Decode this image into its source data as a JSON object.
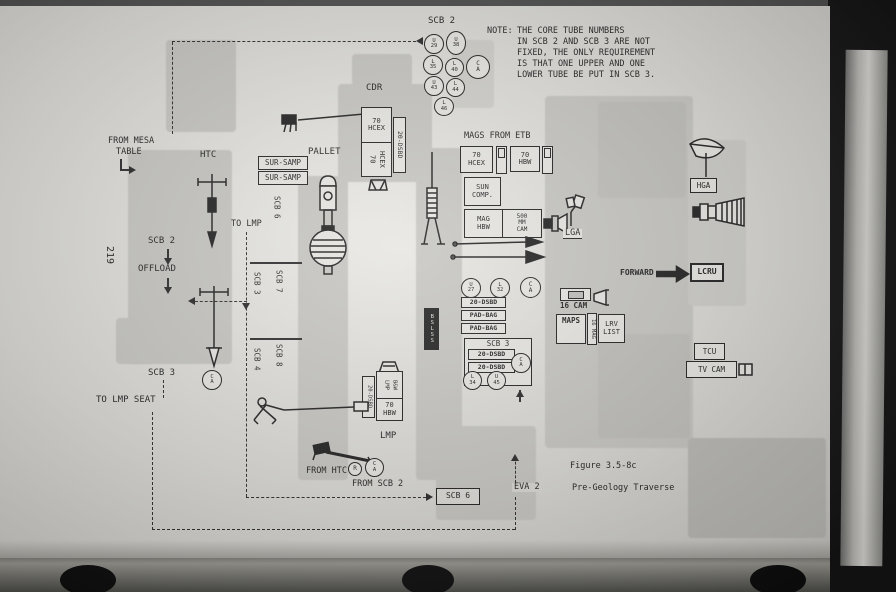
{
  "page_number": "219",
  "note": {
    "label": "NOTE:",
    "lines": [
      "THE CORE TUBE NUMBERS",
      "IN SCB 2 AND SCB 3 ARE NOT",
      "FIXED, THE ONLY REQUIREMENT",
      "IS THAT ONE UPPER AND ONE",
      "LOWER TUBE BE PUT IN SCB 3."
    ]
  },
  "caption": {
    "figure": "Figure 3.5-8c",
    "eva": "EVA 2",
    "title": "Pre-Geology Traverse"
  },
  "labels": {
    "scb2": "SCB 2",
    "scb3": "SCB 3",
    "scb4": "SCB 4",
    "scb6": "SCB 6",
    "scb7": "SCB 7",
    "scb8": "SCB 8",
    "cdr": "CDR",
    "lmp": "LMP",
    "htc": "HTC",
    "pallet": "PALLET",
    "from_mesa": "FROM MESA",
    "table": "TABLE",
    "sur_samp": "SUR-SAMP",
    "to_lmp": "TO LMP",
    "offload": "OFFLOAD",
    "to_lmp_seat": "TO LMP SEAT",
    "mags_from_etb": "MAGS FROM ETB",
    "seventy": "70",
    "hcex": "HCEX",
    "hbw": "HBW",
    "sun": "SUN",
    "comp": "COMP.",
    "mag": "MAG",
    "f500": "500",
    "mm": "MM",
    "cam": "CAM",
    "lga": "LGA",
    "bslss": "BSLSS",
    "forward": "FORWARD",
    "lcru": "LCRU",
    "hga": "HGA",
    "tcu": "TCU",
    "tv_cam": "TV CAM",
    "cam16": "16 CAM",
    "maps": "MAPS",
    "lrv": "LRV",
    "list": "LIST",
    "mag16": "16 MAG",
    "dsbd": "20-DSBD",
    "pad_bag": "PAD-BAG",
    "from_htc": "FROM HTC",
    "from_scb2": "FROM SCB 2",
    "lmp_mag": "LMP",
    "bw": "B&W"
  },
  "tubes_scb2": [
    {
      "a": "U",
      "b": "29"
    },
    {
      "a": "U",
      "b": "38"
    },
    {
      "a": "L",
      "b": "35"
    },
    {
      "a": "L",
      "b": "40"
    },
    {
      "a": "U",
      "b": "43"
    },
    {
      "a": "L",
      "b": "44"
    },
    {
      "a": "L",
      "b": "46"
    }
  ],
  "tubes_mid": [
    {
      "a": "U",
      "b": "27"
    },
    {
      "a": "L",
      "b": "32"
    }
  ],
  "scb3_tubes": [
    {
      "a": "L",
      "b": "34"
    },
    {
      "a": "U",
      "b": "45"
    }
  ],
  "cap": {
    "a": "C",
    "b": "A"
  },
  "r_tag": "R",
  "colors": {
    "ink": "#1e1e1e",
    "paper": "#d9d8d4",
    "shade": "#c6c5c1"
  }
}
